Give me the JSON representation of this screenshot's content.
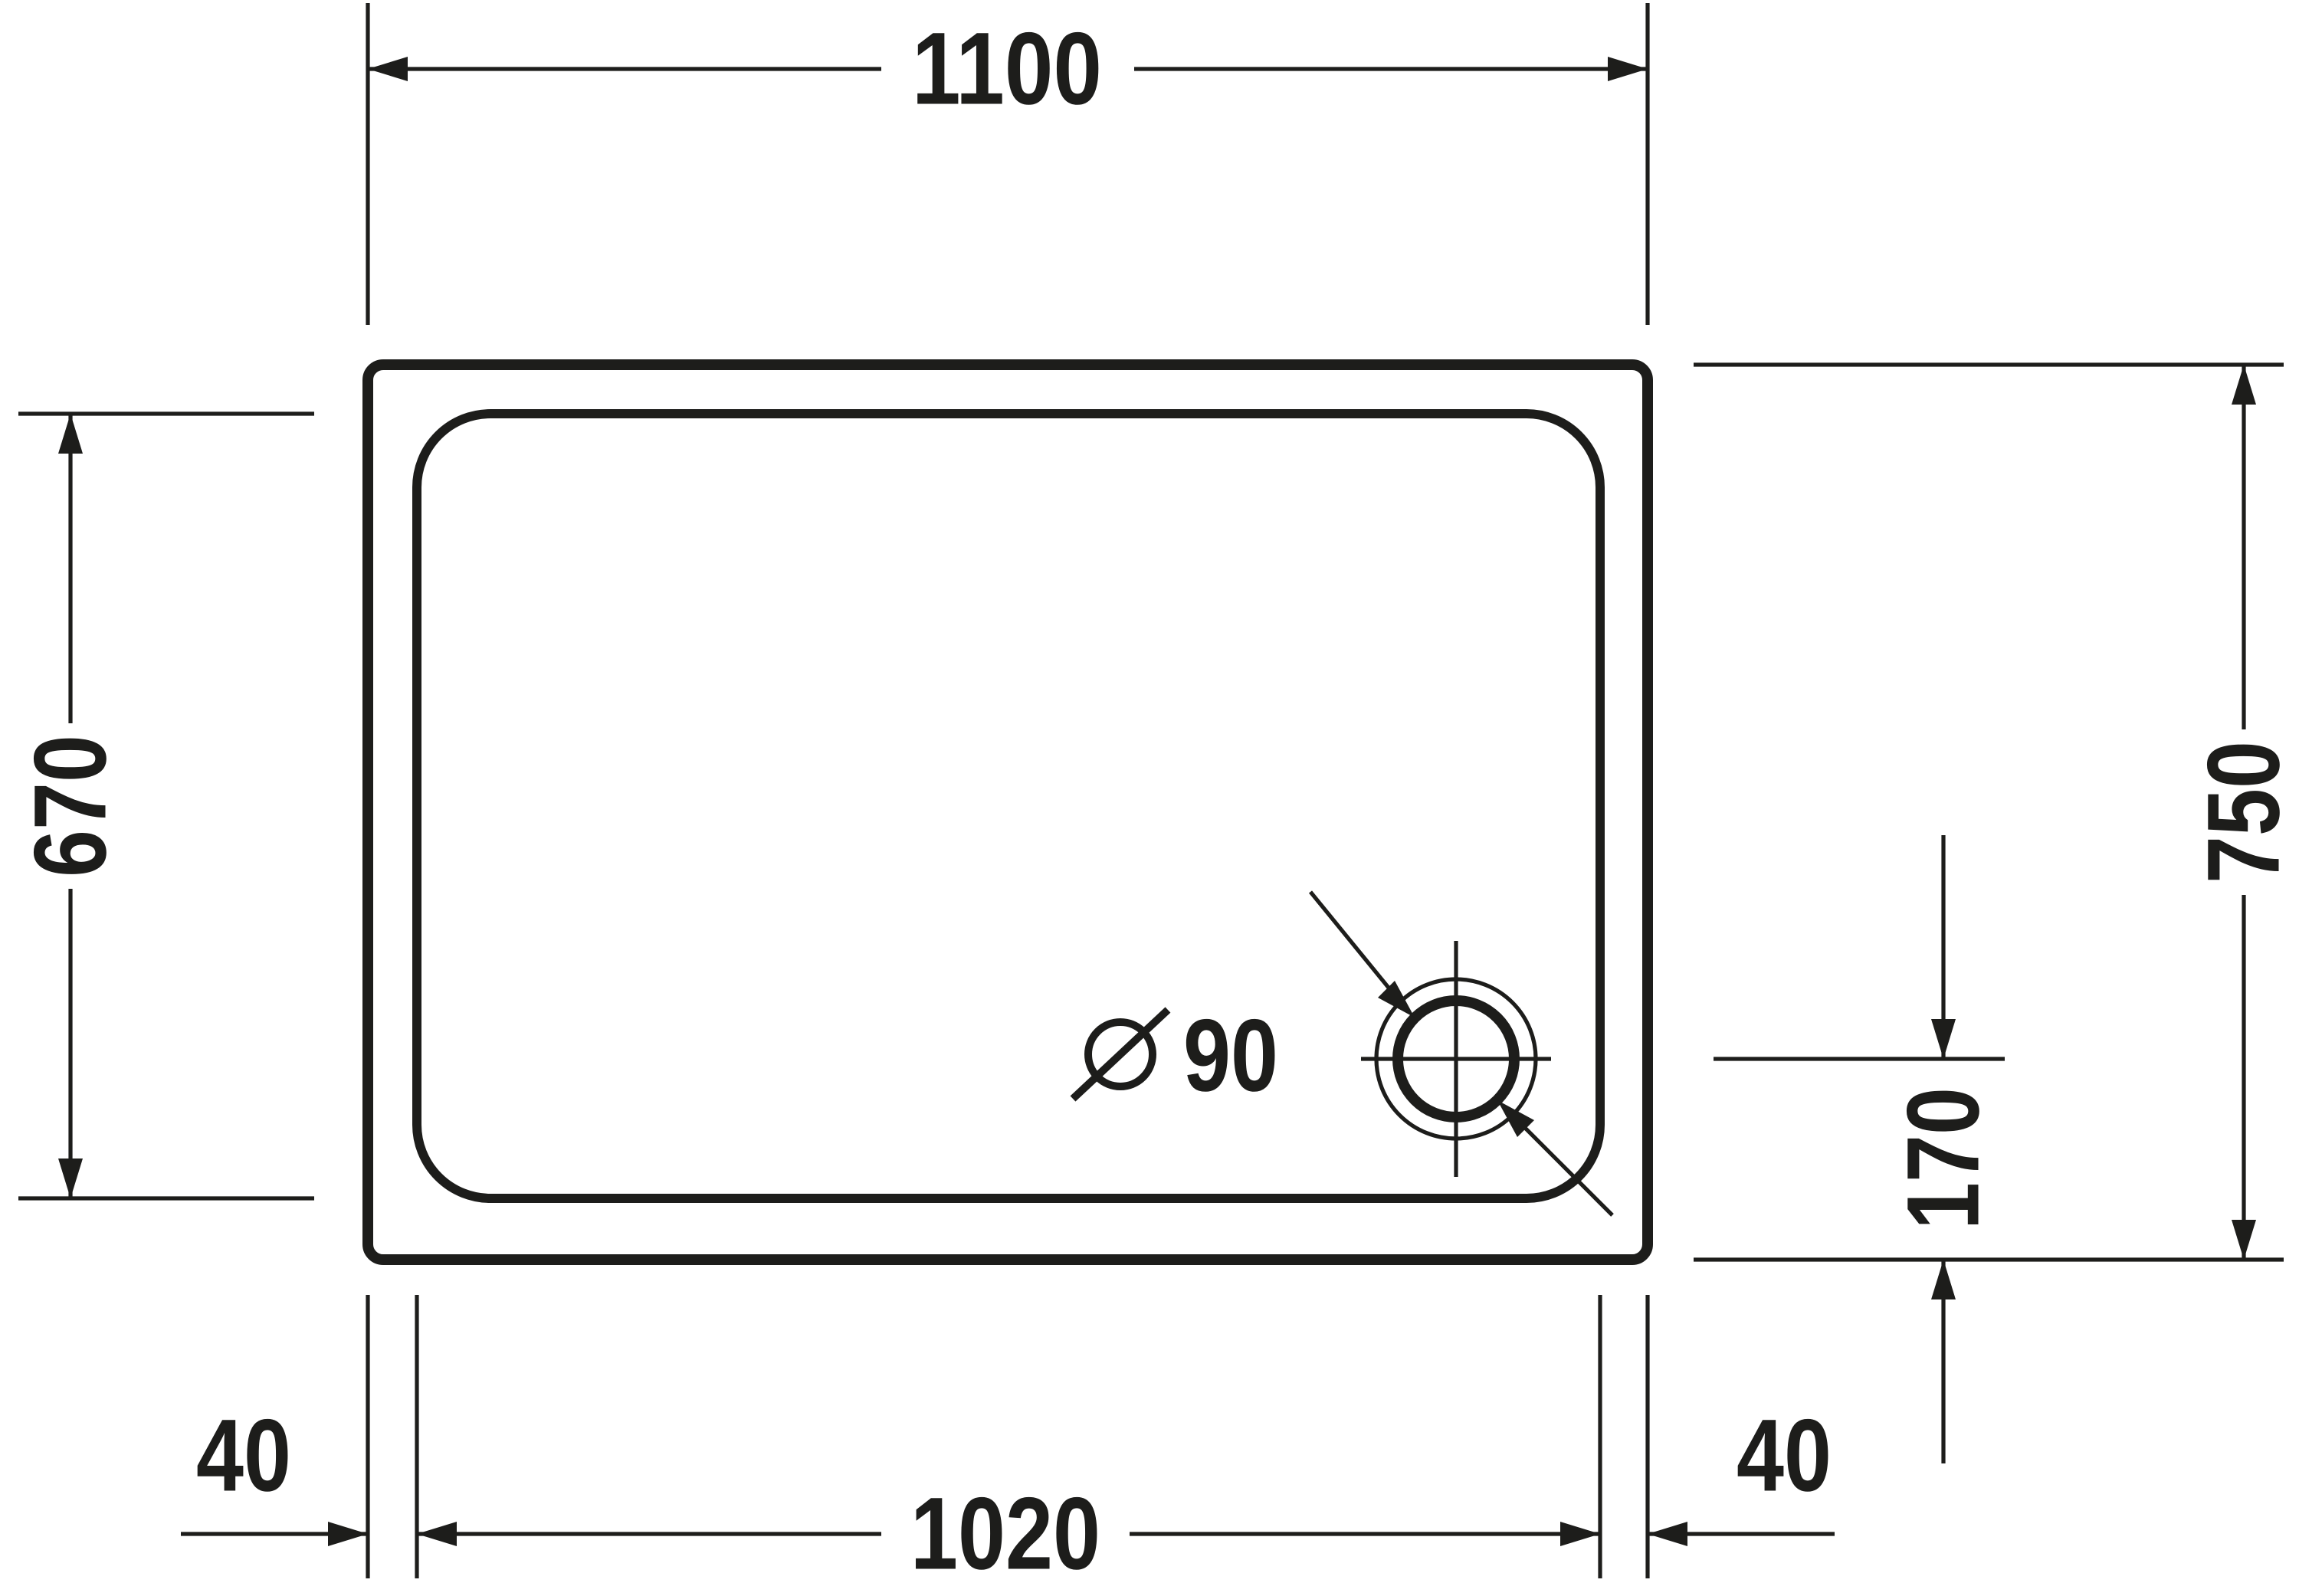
{
  "meta": {
    "background_color": "#ffffff",
    "ink_color": "#1d1d1b",
    "drawing_kind": "technical dimension drawing, shower tray plan view"
  },
  "dimensions": {
    "top_width": "1100",
    "left_height": "670",
    "right_height": "750",
    "drain_offset": "170",
    "bottom_left_rim": "40",
    "bottom_inner_width": "1020",
    "bottom_right_rim": "40",
    "drain_diameter_value": "90"
  },
  "icons": {
    "diameter_symbol": "diameter-icon",
    "drain": "drain-icon"
  }
}
